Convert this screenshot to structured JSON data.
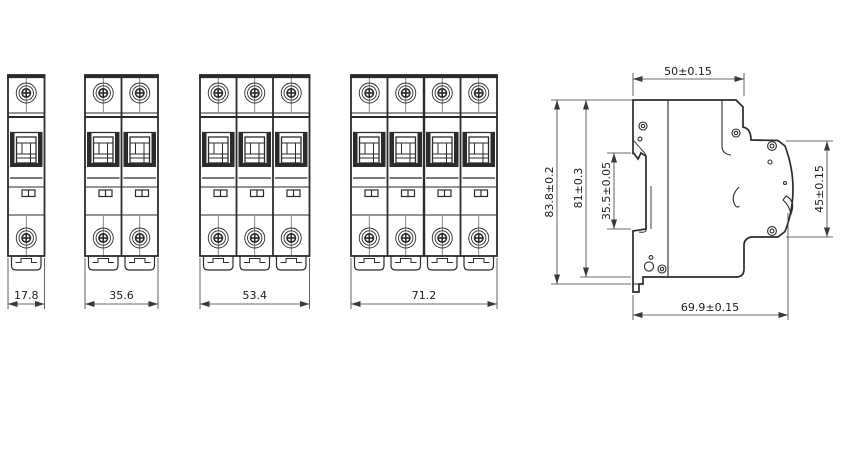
{
  "drawing": {
    "type": "engineering-dimension-drawing",
    "subject": "miniature-circuit-breaker (MCB) front views 1P/2P/3P/4P and side view",
    "line_color": "#2b2b2b",
    "dim_color": "#3a3a3a",
    "background": "#ffffff",
    "front_views": [
      {
        "poles": 1,
        "width_label": "17.8"
      },
      {
        "poles": 2,
        "width_label": "35.6"
      },
      {
        "poles": 3,
        "width_label": "53.4"
      },
      {
        "poles": 4,
        "width_label": "71.2"
      }
    ],
    "side_view": {
      "top_width_label": "50±0.15",
      "overall_height_label": "83.8±0.2",
      "body_height_label": "81±0.3",
      "din_recess_label": "35.5±0.05",
      "front_face_label": "45±0.15",
      "overall_depth_label": "69.9±0.15"
    }
  }
}
